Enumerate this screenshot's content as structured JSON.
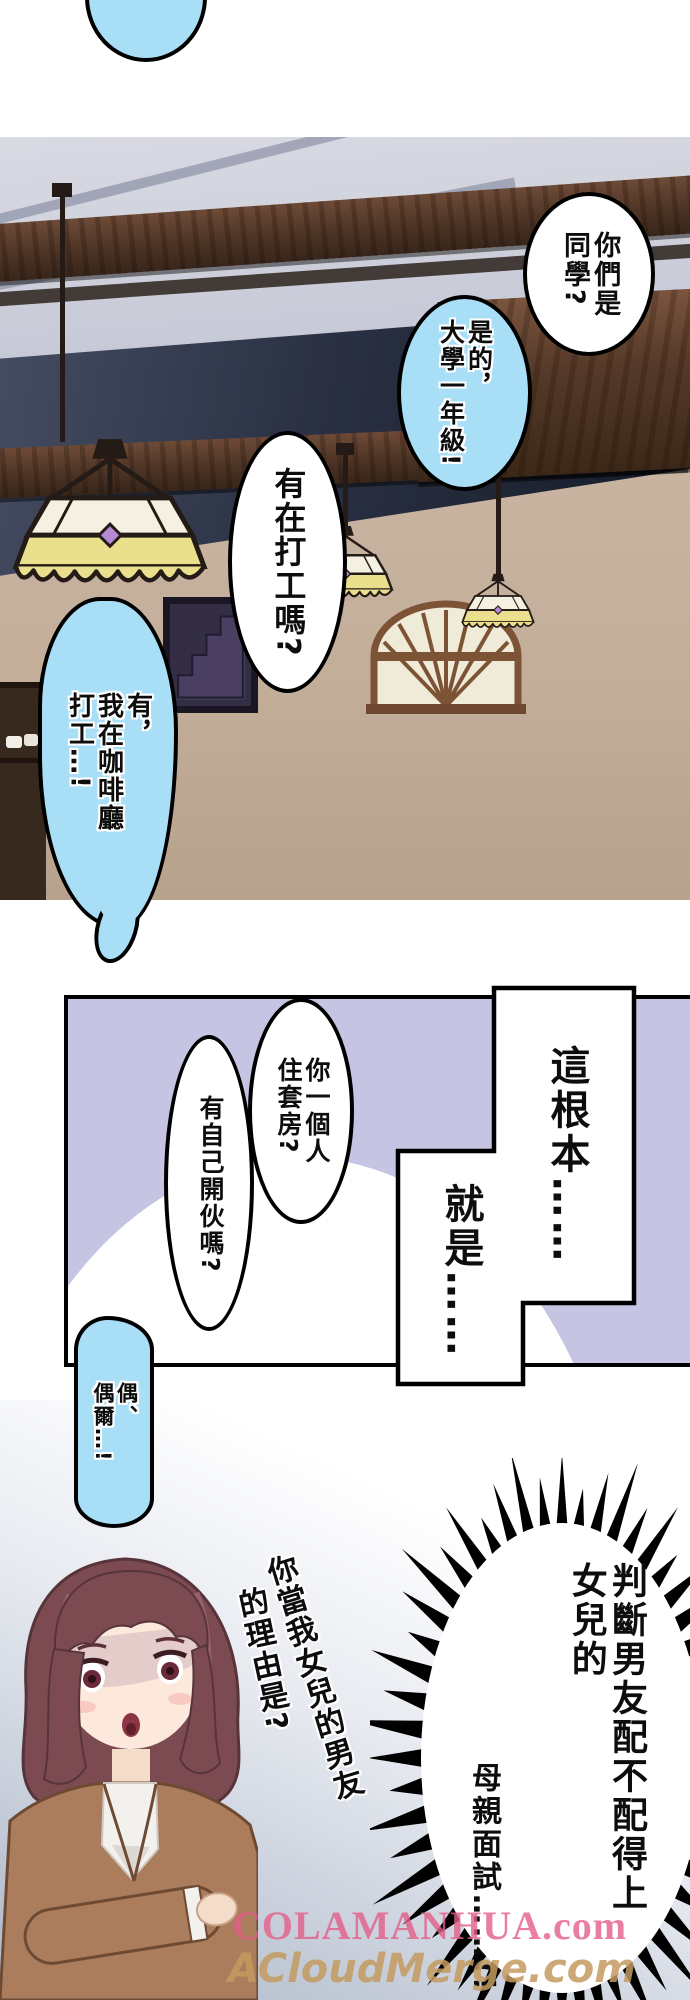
{
  "colors": {
    "bubble_cyan": "#a9def7",
    "panel2_bg": "#c5c4e3",
    "lamp_glass_yellow": "#e9df8d",
    "wood_beam": "#5d3f2e",
    "watermark_pink": "#e25e88",
    "watermark_tan": "#c39a5e"
  },
  "panel1": {
    "bubble_classmates": "你們是\n同學?",
    "bubble_yes_freshman": "是的，\n大學一年級!",
    "bubble_parttime_q": "有在打工嗎?",
    "bubble_cafe": "有，\n我在咖啡廳\n打工…!"
  },
  "panel2": {
    "caption_this_is": "這根本……",
    "caption_basically": "就是……",
    "bubble_live_alone": "你一個人\n住套房?",
    "bubble_cook_q": "有自己開伙嗎?",
    "bubble_sometimes": "偶、\n偶爾…!"
  },
  "panel3": {
    "handwritten_right": "你當我女兒的男友",
    "handwritten_left": "的理由是?",
    "shout_main": "判斷男友配不配得上\n女兒的",
    "shout_sub": "母親面試……!!",
    "watermark_line1": "COLAMANHUA.com",
    "watermark_line2": "ACloudMerge.com"
  }
}
